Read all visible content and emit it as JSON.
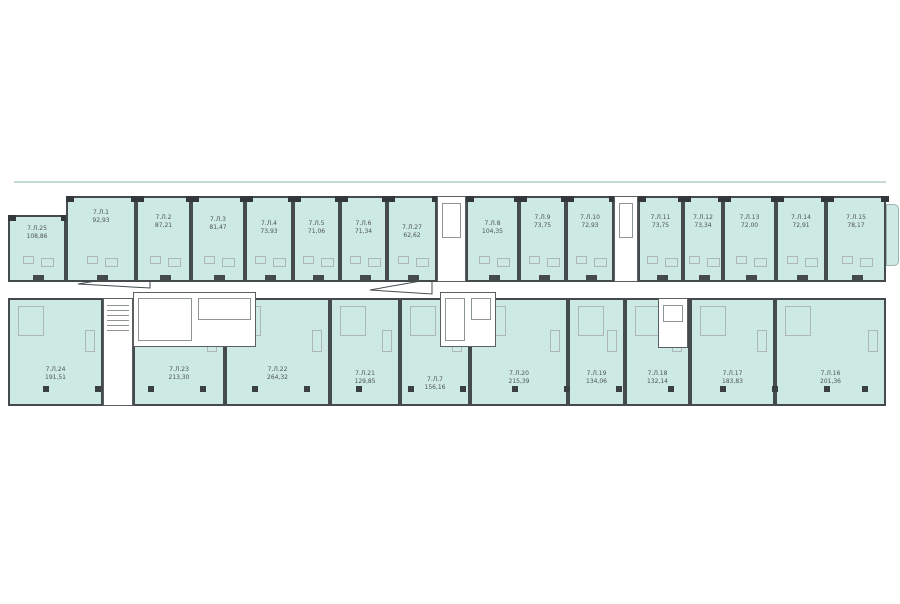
{
  "plan": {
    "title": "floor-plan-level-7",
    "colors": {
      "unit_fill": "#cde9e4",
      "wall_dark": "#454b4d",
      "wall_mid": "#5a6062",
      "fixture_gray": "#aeb6b8",
      "label_text": "#4e5456",
      "background": "#ffffff",
      "balcony_line": "#c6dbd7"
    },
    "top_units": [
      {
        "id": "7.Л.25",
        "area": "108,86",
        "x": 8,
        "y": 215,
        "w": 58,
        "h": 67,
        "label_dy": 8
      },
      {
        "id": "7.Л.1",
        "area": "92,93",
        "x": 66,
        "y": 196,
        "w": 70,
        "h": 86,
        "label_dy": 11
      },
      {
        "id": "7.Л.2",
        "area": "87,21",
        "x": 136,
        "y": 196,
        "w": 55,
        "h": 86,
        "label_dy": 16
      },
      {
        "id": "7.Л.3",
        "area": "81,47",
        "x": 191,
        "y": 196,
        "w": 54,
        "h": 86,
        "label_dy": 18
      },
      {
        "id": "7.Л.4",
        "area": "73,93",
        "x": 245,
        "y": 196,
        "w": 48,
        "h": 86,
        "label_dy": 22
      },
      {
        "id": "7.Л.5",
        "area": "71,06",
        "x": 293,
        "y": 196,
        "w": 47,
        "h": 86,
        "label_dy": 22
      },
      {
        "id": "7.Л.6",
        "area": "71,34",
        "x": 340,
        "y": 196,
        "w": 47,
        "h": 86,
        "label_dy": 22
      },
      {
        "id": "7.Л.27",
        "area": "62,62",
        "x": 387,
        "y": 196,
        "w": 50,
        "h": 86,
        "label_dy": 26
      },
      {
        "id": "7.Л.8",
        "area": "104,35",
        "x": 466,
        "y": 196,
        "w": 53,
        "h": 86,
        "label_dy": 22
      },
      {
        "id": "7.Л.9",
        "area": "73,75",
        "x": 519,
        "y": 196,
        "w": 47,
        "h": 86,
        "label_dy": 16
      },
      {
        "id": "7.Л.10",
        "area": "72,93",
        "x": 566,
        "y": 196,
        "w": 48,
        "h": 86,
        "label_dy": 16
      },
      {
        "id": "7.Л.11",
        "area": "73,75",
        "x": 638,
        "y": 196,
        "w": 45,
        "h": 86,
        "label_dy": 16
      },
      {
        "id": "7.Л.12",
        "area": "73,34",
        "x": 683,
        "y": 196,
        "w": 40,
        "h": 86,
        "label_dy": 16
      },
      {
        "id": "7.Л.13",
        "area": "72,00",
        "x": 723,
        "y": 196,
        "w": 53,
        "h": 86,
        "label_dy": 16
      },
      {
        "id": "7.Л.14",
        "area": "72,91",
        "x": 776,
        "y": 196,
        "w": 50,
        "h": 86,
        "label_dy": 16
      },
      {
        "id": "7.Л.15",
        "area": "78,17",
        "x": 826,
        "y": 196,
        "w": 60,
        "h": 86,
        "label_dy": 16
      }
    ],
    "bottom_units": [
      {
        "id": "7.Л.24",
        "area": "191,51",
        "x": 8,
        "y": 298,
        "w": 95,
        "h": 108,
        "label_dy": 66
      },
      {
        "id": "7.Л.23",
        "area": "213,30",
        "x": 133,
        "y": 298,
        "w": 92,
        "h": 108,
        "label_dy": 66
      },
      {
        "id": "7.Л.22",
        "area": "264,32",
        "x": 225,
        "y": 298,
        "w": 105,
        "h": 108,
        "label_dy": 66
      },
      {
        "id": "7.Л.21",
        "area": "129,85",
        "x": 330,
        "y": 298,
        "w": 70,
        "h": 108,
        "label_dy": 70
      },
      {
        "id": "7.Л.7",
        "area": "156,16",
        "x": 400,
        "y": 298,
        "w": 70,
        "h": 108,
        "label_dy": 76
      },
      {
        "id": "7.Л.20",
        "area": "215,39",
        "x": 470,
        "y": 298,
        "w": 98,
        "h": 108,
        "label_dy": 70
      },
      {
        "id": "7.Л.19",
        "area": "134,06",
        "x": 568,
        "y": 298,
        "w": 57,
        "h": 108,
        "label_dy": 70
      },
      {
        "id": "7.Л.18",
        "area": "132,14",
        "x": 625,
        "y": 298,
        "w": 65,
        "h": 108,
        "label_dy": 70
      },
      {
        "id": "7.Л.17",
        "area": "183,83",
        "x": 690,
        "y": 298,
        "w": 85,
        "h": 108,
        "label_dy": 70
      },
      {
        "id": "7.Л.16",
        "area": "201,36",
        "x": 775,
        "y": 298,
        "w": 111,
        "h": 108,
        "label_dy": 70
      }
    ],
    "cores": [
      {
        "name": "top-core-a",
        "x": 437,
        "y": 196,
        "w": 29,
        "h": 86,
        "kind": "shaft"
      },
      {
        "name": "top-core-b",
        "x": 614,
        "y": 196,
        "w": 24,
        "h": 86,
        "kind": "shaft"
      },
      {
        "name": "stair-core-left",
        "x": 103,
        "y": 298,
        "w": 30,
        "h": 108,
        "kind": "stair"
      },
      {
        "name": "lobby-core-left",
        "x": 133,
        "y": 292,
        "w": 123,
        "h": 55,
        "kind": "lobby"
      },
      {
        "name": "core-mid",
        "x": 440,
        "y": 292,
        "w": 56,
        "h": 55,
        "kind": "lobby"
      },
      {
        "name": "core-right",
        "x": 658,
        "y": 298,
        "w": 30,
        "h": 50,
        "kind": "shaft"
      }
    ],
    "columns": {
      "y": 386,
      "xs": [
        43,
        95,
        148,
        200,
        252,
        304,
        356,
        408,
        460,
        512,
        564,
        616,
        668,
        720,
        772,
        824,
        862
      ]
    },
    "arrows": [
      {
        "name": "corridor-arrow-left",
        "points": "150,272 78,284 150,288"
      },
      {
        "name": "corridor-arrow-mid",
        "points": "432,279 370,290 432,294"
      }
    ],
    "balcony_line": {
      "x": 14,
      "y": 181,
      "w": 872
    },
    "terrace": {
      "x": 886,
      "y": 204,
      "w": 13,
      "h": 62
    }
  }
}
